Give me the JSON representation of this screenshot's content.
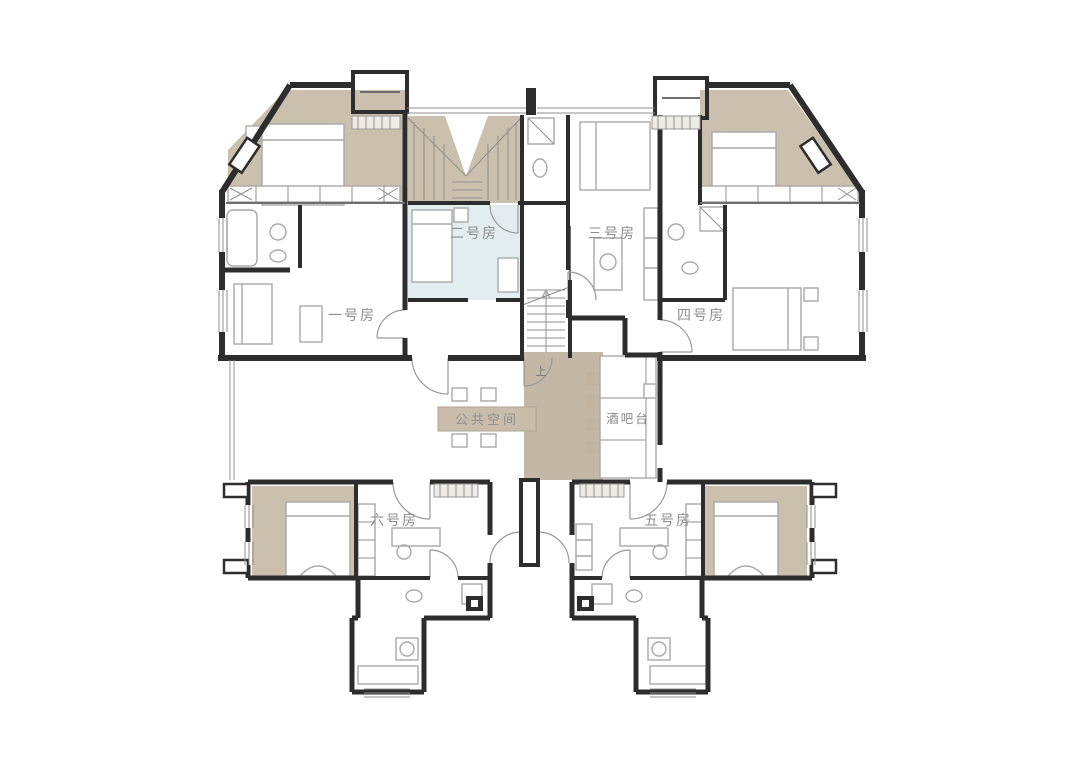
{
  "floorplan": {
    "rooms": [
      {
        "id": "room-1",
        "label": "一号房"
      },
      {
        "id": "room-2",
        "label": "二号房"
      },
      {
        "id": "room-3",
        "label": "三号房"
      },
      {
        "id": "room-4",
        "label": "四号房"
      },
      {
        "id": "room-5",
        "label": "五号房"
      },
      {
        "id": "room-6",
        "label": "六号房"
      }
    ],
    "areas": {
      "public_space": "公共空间",
      "bar_counter": "酒吧台"
    },
    "stairs": {
      "up_label": "上",
      "direction_icon": "up-arrow"
    },
    "icons": {
      "vent_grille": "hatched-rect",
      "door_swing": "quarter-arc",
      "bed": "rect-with-pillow-line",
      "bar_stool": "tan-square"
    },
    "colors": {
      "wall": "#2d2d2d",
      "wood_floor": "#cbbfae",
      "corridor_floor": "#c4b7a5",
      "room2_tint": "#dceaec",
      "label_text": "#8e8e8e",
      "furniture_line": "#a9a9a9",
      "table_box": "#c9bcab",
      "background": "#ffffff"
    }
  }
}
